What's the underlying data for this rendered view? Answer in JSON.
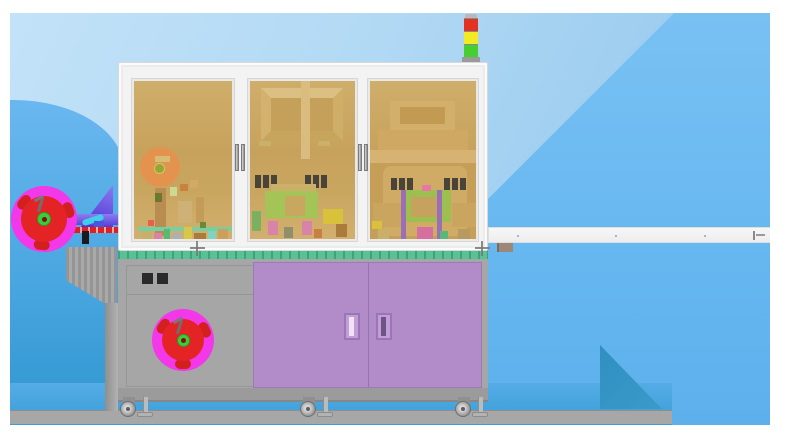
{
  "colors": {
    "bg_light": "#b9dcf6",
    "bg_medium": "#66b7f0",
    "bg_deepest": "#2f96cf",
    "shadow_teal": "#2f8fc0",
    "floor_gray": "#a7a7a7",
    "frame_white": "#f3f3f3",
    "frame_line": "#d8d8d8",
    "glass_top": "#cfae6b",
    "glass_mid": "#c7a25c",
    "glass_bottom": "#d2af6e",
    "tower_red": "#e23222",
    "tower_yellow": "#f2ea25",
    "tower_green": "#46cf2f",
    "metal_gray": "#9a9a9a",
    "reel_magenta": "#f238e8",
    "reel_red": "#e42424",
    "reel_hub_green": "#3fca3a",
    "reel_core": "#7c1010",
    "table_green": "#57c294",
    "cabinet_gray": "#a6a6a6",
    "button_black": "#2a2a2a",
    "door_purple": "#b18cc9",
    "door_divider": "#9372ad",
    "handle_light": "#f2e2f4",
    "handle_dark": "#6f5587",
    "conveyor_white": "#ededed",
    "cone_purple": "#4a2dd0",
    "cone_band": "#8d7cf2",
    "tape_red": "#e02020",
    "clamp_black": "#1c1c1c",
    "cyan_part": "#3fd0e8",
    "orange_reel": "#e6914d"
  },
  "signal_tower": {
    "lamps": [
      {
        "id": "red",
        "color": "#e23222"
      },
      {
        "id": "yellow",
        "color": "#f2ea25"
      },
      {
        "id": "green",
        "color": "#46cf2f"
      }
    ]
  },
  "enclosure": {
    "windows": [
      {
        "id": "process-window-1",
        "parts": [
          {
            "x": 6,
            "y": 66,
            "w": 40,
            "h": 40,
            "color": "#e6914d",
            "round": true,
            "opacity": 0.9
          },
          {
            "x": 21,
            "y": 75,
            "w": 15,
            "h": 6,
            "color": "#d9bc74"
          },
          {
            "x": 20,
            "y": 82,
            "w": 11,
            "h": 11,
            "color": "#9aa23a",
            "round": true,
            "border": "1px solid #c3cf5d"
          },
          {
            "x": 21,
            "y": 107,
            "w": 11,
            "h": 48,
            "color": "#b98d52"
          },
          {
            "x": 21,
            "y": 112,
            "w": 7,
            "h": 9,
            "color": "#6b7a2a"
          },
          {
            "x": 36,
            "y": 106,
            "w": 7,
            "h": 9,
            "color": "#cdd98f"
          },
          {
            "x": 46,
            "y": 103,
            "w": 8,
            "h": 7,
            "color": "#c9813e"
          },
          {
            "x": 56,
            "y": 99,
            "w": 8,
            "h": 8,
            "color": "#d2aa66"
          },
          {
            "x": 44,
            "y": 120,
            "w": 14,
            "h": 22,
            "color": "#cdb176"
          },
          {
            "x": 62,
            "y": 116,
            "w": 8,
            "h": 26,
            "color": "#c29c58"
          },
          {
            "x": 4,
            "y": 146,
            "w": 94,
            "h": 4,
            "color": "#74cfa2"
          },
          {
            "x": 8,
            "y": 150,
            "w": 10,
            "h": 12,
            "color": "#c8b06a"
          },
          {
            "x": 20,
            "y": 152,
            "w": 8,
            "h": 10,
            "color": "#d884a8"
          },
          {
            "x": 30,
            "y": 148,
            "w": 6,
            "h": 14,
            "color": "#58b878"
          },
          {
            "x": 38,
            "y": 152,
            "w": 10,
            "h": 10,
            "color": "#b0b0b0"
          },
          {
            "x": 50,
            "y": 146,
            "w": 8,
            "h": 16,
            "color": "#d8c84a"
          },
          {
            "x": 60,
            "y": 152,
            "w": 12,
            "h": 10,
            "color": "#a97c3c"
          },
          {
            "x": 74,
            "y": 150,
            "w": 8,
            "h": 12,
            "color": "#7fd4c0"
          },
          {
            "x": 84,
            "y": 148,
            "w": 10,
            "h": 14,
            "color": "#caa05c"
          },
          {
            "x": 14,
            "y": 139,
            "w": 6,
            "h": 6,
            "color": "#e8604a"
          },
          {
            "x": 66,
            "y": 141,
            "w": 6,
            "h": 6,
            "color": "#6a8a3a"
          }
        ]
      },
      {
        "id": "process-window-2",
        "parts": [
          {
            "x": 11,
            "y": 7,
            "w": 82,
            "h": 53,
            "color": "#c4a05a",
            "bevel": true
          },
          {
            "x": 51,
            "y": 0,
            "w": 9,
            "h": 78,
            "color": "#d9bc7e"
          },
          {
            "x": 9,
            "y": 60,
            "w": 12,
            "h": 5,
            "color": "#cbb06a"
          },
          {
            "x": 68,
            "y": 60,
            "w": 12,
            "h": 5,
            "color": "#cbb06a"
          },
          {
            "x": 5,
            "y": 94,
            "w": 6,
            "h": 13,
            "color": "#4a4438"
          },
          {
            "x": 13,
            "y": 94,
            "w": 6,
            "h": 13,
            "color": "#4a4438"
          },
          {
            "x": 21,
            "y": 94,
            "w": 6,
            "h": 13,
            "color": "#4a4438"
          },
          {
            "x": 55,
            "y": 94,
            "w": 6,
            "h": 13,
            "color": "#4a4438"
          },
          {
            "x": 63,
            "y": 94,
            "w": 6,
            "h": 13,
            "color": "#4a4438"
          },
          {
            "x": 71,
            "y": 94,
            "w": 6,
            "h": 13,
            "color": "#4a4438"
          },
          {
            "x": 21,
            "y": 103,
            "w": 45,
            "h": 8,
            "color": "#cbb06a"
          },
          {
            "x": 15,
            "y": 110,
            "w": 53,
            "h": 27,
            "color": "#a4c457"
          },
          {
            "x": 35,
            "y": 115,
            "w": 20,
            "h": 20,
            "color": "#c8a85e"
          },
          {
            "x": 73,
            "y": 128,
            "w": 20,
            "h": 15,
            "color": "#d8c23c"
          },
          {
            "x": 2,
            "y": 130,
            "w": 9,
            "h": 20,
            "color": "#7ab060"
          },
          {
            "x": 18,
            "y": 140,
            "w": 10,
            "h": 14,
            "color": "#d884a8"
          },
          {
            "x": 52,
            "y": 140,
            "w": 10,
            "h": 14,
            "color": "#d884a8"
          },
          {
            "x": 34,
            "y": 146,
            "w": 9,
            "h": 11,
            "color": "#8f8f6a"
          },
          {
            "x": 86,
            "y": 143,
            "w": 11,
            "h": 13,
            "color": "#a97c3c"
          },
          {
            "x": 64,
            "y": 148,
            "w": 8,
            "h": 9,
            "color": "#c97f3e"
          }
        ]
      },
      {
        "id": "process-window-3",
        "parts": [
          {
            "x": 8,
            "y": 49,
            "w": 90,
            "h": 33,
            "color": "#cfa964"
          },
          {
            "x": 20,
            "y": 20,
            "w": 65,
            "h": 29,
            "color": "#d2b06c"
          },
          {
            "x": 30,
            "y": 26,
            "w": 45,
            "h": 17,
            "color": "#c39a52"
          },
          {
            "x": 0,
            "y": 69,
            "w": 108,
            "h": 13,
            "color": "#d6b373"
          },
          {
            "x": 0,
            "y": 82,
            "w": 108,
            "h": 76,
            "color": "#c59e58"
          },
          {
            "x": 13,
            "y": 85,
            "w": 84,
            "h": 70,
            "color": "#d0ab66",
            "radius": "8px 8px 0 0"
          },
          {
            "x": 21,
            "y": 97,
            "w": 6,
            "h": 12,
            "color": "#4a4438"
          },
          {
            "x": 29,
            "y": 97,
            "w": 6,
            "h": 12,
            "color": "#4a4438"
          },
          {
            "x": 37,
            "y": 97,
            "w": 6,
            "h": 12,
            "color": "#4a4438"
          },
          {
            "x": 74,
            "y": 97,
            "w": 6,
            "h": 12,
            "color": "#4a4438"
          },
          {
            "x": 82,
            "y": 97,
            "w": 6,
            "h": 12,
            "color": "#4a4438"
          },
          {
            "x": 90,
            "y": 97,
            "w": 6,
            "h": 12,
            "color": "#4a4438"
          },
          {
            "x": 3,
            "y": 122,
            "w": 28,
            "h": 24,
            "color": "#c9a55f"
          },
          {
            "x": 82,
            "y": 122,
            "w": 24,
            "h": 24,
            "color": "#c9a55f"
          },
          {
            "x": 33,
            "y": 109,
            "w": 48,
            "h": 32,
            "color": "#9cc050"
          },
          {
            "x": 41,
            "y": 116,
            "w": 26,
            "h": 20,
            "color": "#c6a25e"
          },
          {
            "x": 31,
            "y": 109,
            "w": 5,
            "h": 49,
            "color": "#9a6fb5"
          },
          {
            "x": 67,
            "y": 109,
            "w": 5,
            "h": 49,
            "color": "#9a6fb5"
          },
          {
            "x": 52,
            "y": 104,
            "w": 9,
            "h": 6,
            "color": "#e877a8"
          },
          {
            "x": 47,
            "y": 146,
            "w": 16,
            "h": 12,
            "color": "#d66fa0"
          },
          {
            "x": 8,
            "y": 148,
            "w": 11,
            "h": 10,
            "color": "#c8b06a"
          },
          {
            "x": 88,
            "y": 148,
            "w": 12,
            "h": 10,
            "color": "#b89a60"
          },
          {
            "x": 70,
            "y": 150,
            "w": 8,
            "h": 8,
            "color": "#58b878"
          },
          {
            "x": 2,
            "y": 140,
            "w": 10,
            "h": 8,
            "color": "#d8c23c"
          }
        ]
      }
    ]
  },
  "conveyor": {
    "dot_offsets": [
      28,
      126,
      215
    ]
  },
  "base": {
    "casters": [
      {
        "x": 110
      },
      {
        "x": 290
      },
      {
        "x": 445
      }
    ]
  },
  "fiducials": [
    {
      "x": 187,
      "y": 235
    },
    {
      "x": 472,
      "y": 235
    }
  ]
}
